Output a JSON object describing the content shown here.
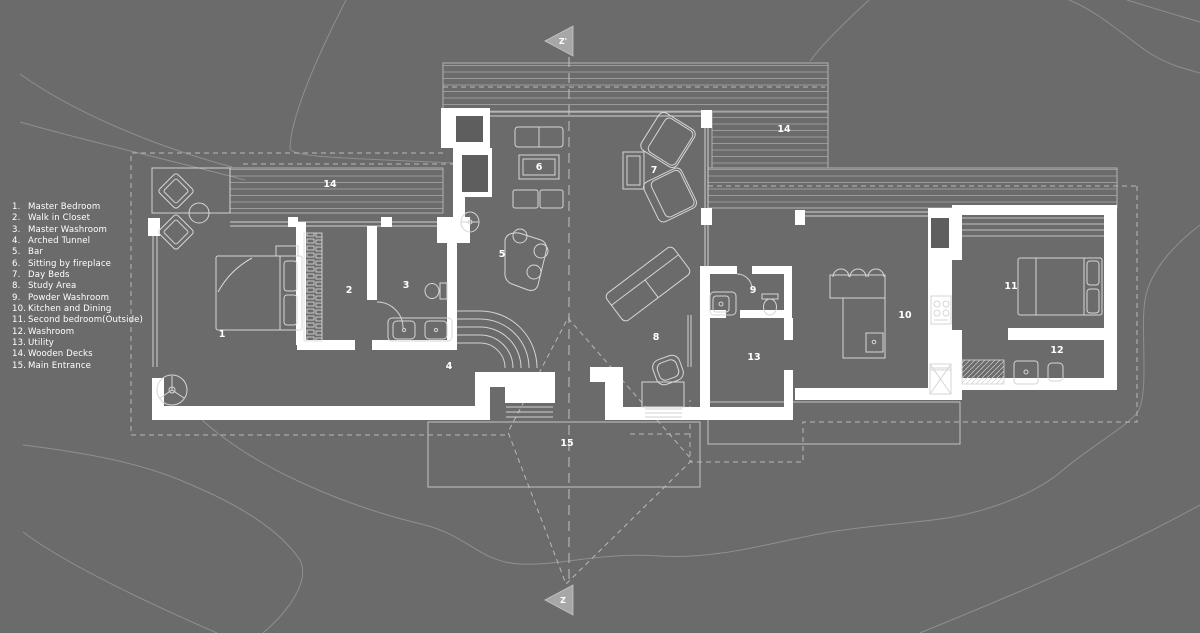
{
  "legend": {
    "items": [
      {
        "num": "1.",
        "label": "Master Bedroom"
      },
      {
        "num": "2.",
        "label": "Walk in Closet"
      },
      {
        "num": "3.",
        "label": "Master Washroom"
      },
      {
        "num": "4.",
        "label": "Arched Tunnel"
      },
      {
        "num": "5.",
        "label": "Bar"
      },
      {
        "num": "6.",
        "label": "Sitting by fireplace"
      },
      {
        "num": "7.",
        "label": "Day Beds"
      },
      {
        "num": "8.",
        "label": "Study Area"
      },
      {
        "num": "9.",
        "label": "Powder Washroom"
      },
      {
        "num": "10.",
        "label": "Kitchen and Dining"
      },
      {
        "num": "11.",
        "label": "Second bedroom(Outside)"
      },
      {
        "num": "12.",
        "label": "Washroom"
      },
      {
        "num": "13.",
        "label": "Utility"
      },
      {
        "num": "14.",
        "label": "Wooden Decks"
      },
      {
        "num": "15.",
        "label": "Main Entrance"
      }
    ]
  },
  "plan": {
    "room_labels": {
      "r1": "1",
      "r2": "2",
      "r3": "3",
      "r4": "4",
      "r5": "5",
      "r6": "6",
      "r7": "7",
      "r8": "8",
      "r9": "9",
      "r10": "10",
      "r11": "11",
      "r12": "12",
      "r13": "13",
      "deck_left": "14",
      "deck_right": "14",
      "r15": "15"
    }
  },
  "sections": {
    "top": "Z'",
    "bottom": "Z"
  },
  "colors": {
    "background": "#6b6b6b",
    "walls": "#ffffff",
    "plan_lines": "#d2d2d2",
    "contours": "#8f8f8f",
    "dashed": "#b8b8b8",
    "deck_boards": "#9a9a9a",
    "labels": "#ffffff",
    "section_marker": "#a7a7a7"
  }
}
